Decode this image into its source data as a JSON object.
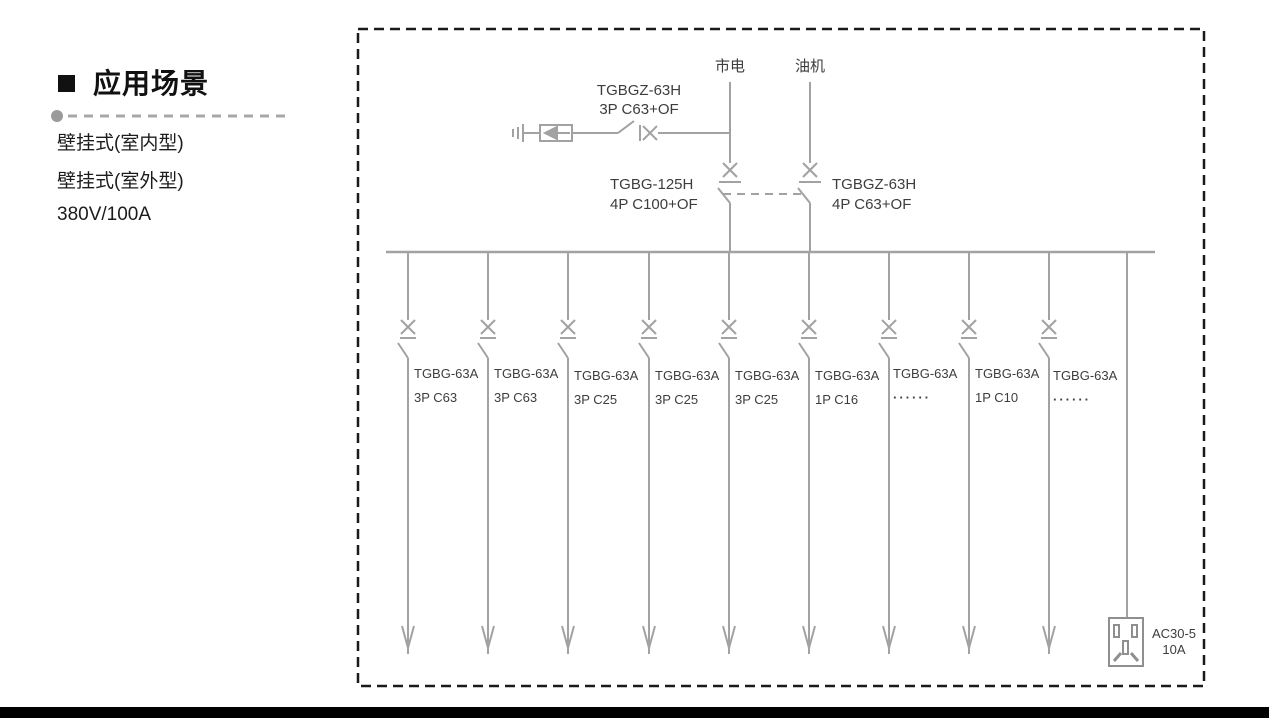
{
  "intro": {
    "section_title": "应用场景",
    "features": [
      "壁挂式(室内型)",
      "壁挂式(室外型)",
      "380V/100A"
    ]
  },
  "diagram": {
    "sources": [
      {
        "label": "市电"
      },
      {
        "label": "油机"
      }
    ],
    "spd_branch": {
      "model": "TGBGZ-63H",
      "rating": "3P C63+OF"
    },
    "main_breakers": [
      {
        "model": "TGBG-125H",
        "rating": "4P C100+OF"
      },
      {
        "model": "TGBGZ-63H",
        "rating": "4P C63+OF"
      }
    ],
    "feeders": [
      {
        "model": "TGBG-63A",
        "rating": "3P C63"
      },
      {
        "model": "TGBG-63A",
        "rating": "3P C63"
      },
      {
        "model": "TGBG-63A",
        "rating": "3P C25"
      },
      {
        "model": "TGBG-63A",
        "rating": "3P C25"
      },
      {
        "model": "TGBG-63A",
        "rating": "3P C25"
      },
      {
        "model": "TGBG-63A",
        "rating": "1P C16"
      },
      {
        "model": "TGBG-63A",
        "rating": "······"
      },
      {
        "model": "TGBG-63A",
        "rating": "1P C10"
      },
      {
        "model": "TGBG-63A",
        "rating": "······"
      }
    ],
    "socket": {
      "model": "AC30-5",
      "rating": "10A"
    }
  },
  "colors": {
    "diagram_line": "#a2a2a2",
    "diagram_text": "#3d3d3d",
    "border_dash": "#1a1a1a",
    "bottom_bar": "#000000"
  }
}
